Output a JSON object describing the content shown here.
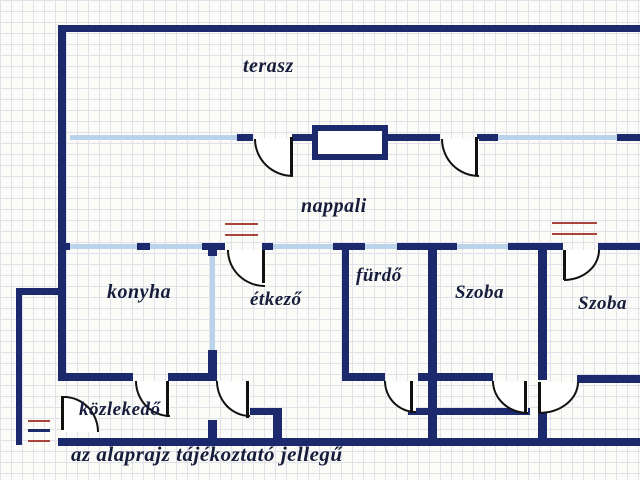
{
  "plan": {
    "rooms": [
      {
        "id": "terasz",
        "label": "terasz"
      },
      {
        "id": "nappali",
        "label": "nappali"
      },
      {
        "id": "konyha",
        "label": "konyha"
      },
      {
        "id": "etkezo",
        "label": "étkező"
      },
      {
        "id": "furdo",
        "label": "fürdő"
      },
      {
        "id": "szoba1",
        "label": "Szoba"
      },
      {
        "id": "szoba2",
        "label": "Szoba"
      },
      {
        "id": "kozlekedo",
        "label": "közlekedő"
      }
    ],
    "disclaimer": "az alaprajz tájékoztató jellegű",
    "symbols": {
      "door": "quarter-circle door swing",
      "window": "light blue wall segment",
      "radiator": "red double line"
    }
  },
  "colors": {
    "bg": "#fbfbf7",
    "grid": "#e0e1e9",
    "wall": "#1c2a6d",
    "window": "#b9d3ea",
    "radiator": "#a8443c",
    "text": "#151d3b"
  }
}
